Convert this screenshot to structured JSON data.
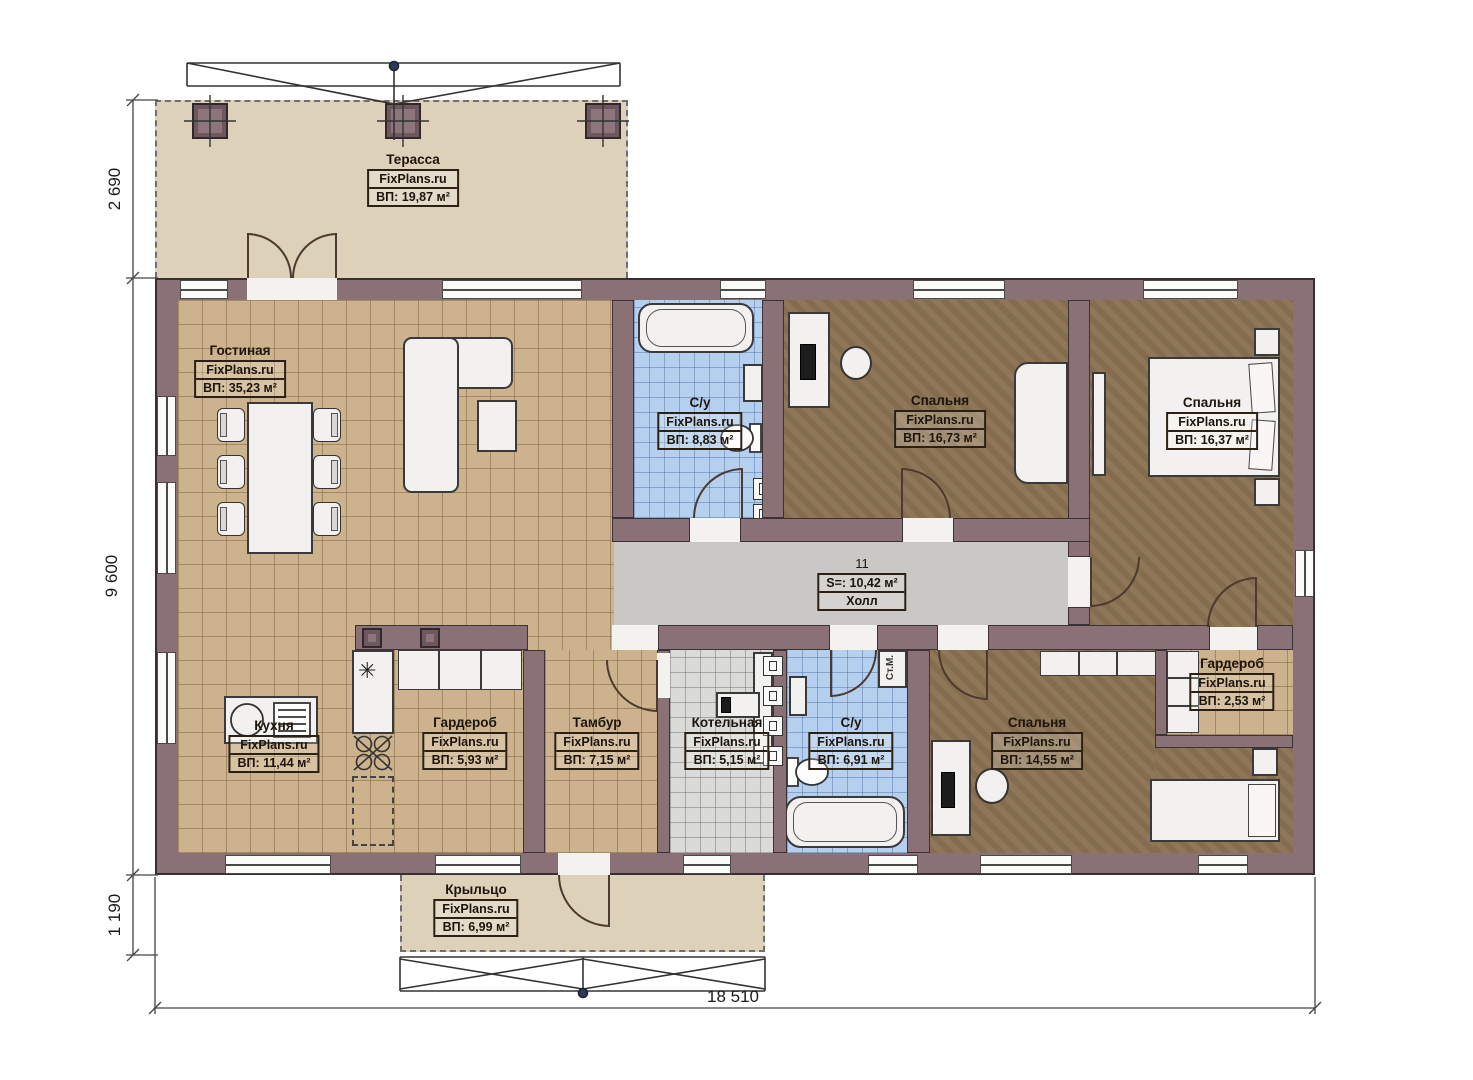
{
  "plan": {
    "rooms": [
      {
        "id": "terrace",
        "name": "Терасса",
        "brand": "FixPlans.ru",
        "area": "ВП: 19,87 м²"
      },
      {
        "id": "living",
        "name": "Гостиная",
        "brand": "FixPlans.ru",
        "area": "ВП: 35,23 м²"
      },
      {
        "id": "bath1",
        "name": "С/у",
        "brand": "FixPlans.ru",
        "area": "ВП: 8,83 м²"
      },
      {
        "id": "bedroom1",
        "name": "Спальня",
        "brand": "FixPlans.ru",
        "area": "ВП: 16,73 м²"
      },
      {
        "id": "bedroom2",
        "name": "Спальня",
        "brand": "FixPlans.ru",
        "area": "ВП: 16,37 м²"
      },
      {
        "id": "hall",
        "number": "11",
        "area": "S=: 10,42 м²",
        "name": "Холл"
      },
      {
        "id": "kitchen",
        "name": "Кухня",
        "brand": "FixPlans.ru",
        "area": "ВП: 11,44 м²"
      },
      {
        "id": "wardrobe1",
        "name": "Гардероб",
        "brand": "FixPlans.ru",
        "area": "ВП: 5,93 м²"
      },
      {
        "id": "tambur",
        "name": "Тамбур",
        "brand": "FixPlans.ru",
        "area": "ВП: 7,15 м²"
      },
      {
        "id": "boiler",
        "name": "Котельная",
        "brand": "FixPlans.ru",
        "area": "ВП: 5,15 м²"
      },
      {
        "id": "bath2",
        "name": "С/у",
        "brand": "FixPlans.ru",
        "area": "ВП: 6,91 м²"
      },
      {
        "id": "bedroom3",
        "name": "Спальня",
        "brand": "FixPlans.ru",
        "area": "ВП: 14,55 м²"
      },
      {
        "id": "wardrobe2",
        "name": "Гардероб",
        "brand": "FixPlans.ru",
        "area": "ВП: 2,53 м²"
      },
      {
        "id": "porch",
        "name": "Крыльцо",
        "brand": "FixPlans.ru",
        "area": "ВП: 6,99 м²"
      }
    ],
    "dimensions": {
      "terrace_height": "2 690",
      "house_height": "9 600",
      "porch_height": "1 190",
      "total_width": "18 510"
    },
    "annotations": {
      "washing_machine": "Ст.М."
    },
    "colors": {
      "wall": "#8a7176",
      "tile_beige": "#cdb28e",
      "tile_blue": "#b5d0ef",
      "floor_brown": "#8b7353",
      "hall_gray": "#c9c8c5",
      "boiler_tile": "#dadad8",
      "outdoor": "#ddd1ba",
      "furniture": "#f2f1ef"
    }
  }
}
